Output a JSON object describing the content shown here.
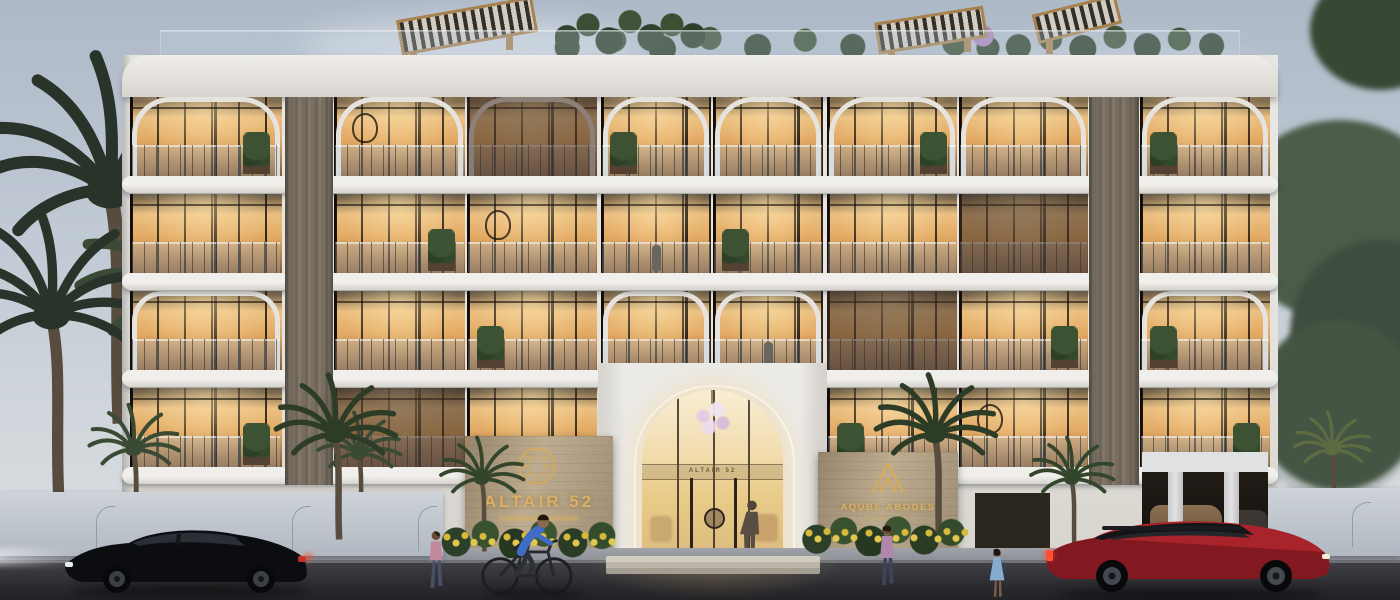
{
  "scene": {
    "type": "architectural-render",
    "time_of_day": "dusk",
    "building_name": "ALTAIR 52",
    "signs": {
      "entrance_plaque_title": "ALTAIR 52",
      "door_lintel_text": "ALTAIR 52",
      "realty_line1": "AQUBE ABODES",
      "realty_line2": "REALTY"
    },
    "building": {
      "balcony_floors": 4,
      "entrance": "double-height arched glass lobby",
      "roof": "terrace with wooden pergolas and planting"
    },
    "vehicles": [
      {
        "name": "black-suv",
        "color": "#0e0f12",
        "position": "left",
        "heading": "left"
      },
      {
        "name": "red-suv",
        "color": "#a8232b",
        "position": "right",
        "heading": "right"
      }
    ],
    "people": [
      {
        "name": "pedestrian-left",
        "desc": "woman walking on left sidewalk"
      },
      {
        "name": "cyclist",
        "desc": "man in blue shirt riding bicycle"
      },
      {
        "name": "pedestrian-near-sign",
        "desc": "woman walking near realty sign"
      },
      {
        "name": "pedestrian-right",
        "desc": "woman in blue dress"
      },
      {
        "name": "lobby-visitor",
        "desc": "person standing inside entrance"
      }
    ],
    "colors": {
      "sky_top": "#aeb9c8",
      "sky_horizon": "#d6dade",
      "facade": "#e6e3de",
      "slab_light": "#f1efeb",
      "slab_dark": "#d5d2cc",
      "window_glow_bright": "#f4d49c",
      "window_glow": "#e2a963",
      "window_glow_deep": "#8a5c32",
      "wood_panel": "#7b7265",
      "stone_sign_wall": "#b3a186",
      "sign_gold": "#d9b065",
      "street": "#35353a",
      "sidewalk": "#94979d",
      "black_suv": "#0e0f12",
      "red_suv": "#a8232b",
      "foliage_dark": "#2b3a2d",
      "foliage_light": "#5c6e55"
    }
  }
}
